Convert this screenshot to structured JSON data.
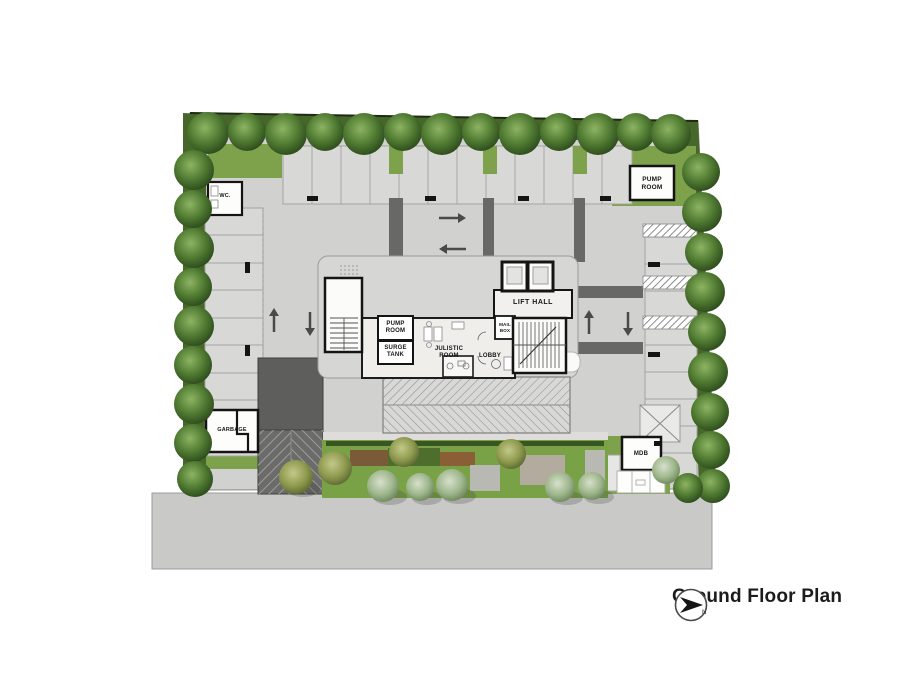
{
  "plan": {
    "caption": "Ground Floor Plan",
    "north_letter": "N",
    "labels": {
      "pump_room_ne": "PUMP\nROOM",
      "wc": "WC.",
      "pump_room": "PUMP\nROOM",
      "surge_tank": "SURGE\nTANK",
      "julistic_room": "JULISTIC\nROOM",
      "lobby": "LOBBY",
      "mail_box": "MAIL\nBOX",
      "lift_hall": "LIFT HALL",
      "garbage": "GARBAGE",
      "mdb": "MDB"
    },
    "colors": {
      "tree_dark": "#4e7a30",
      "tree_sage": "#a4bb92",
      "grass": "#7da24b",
      "hedge": "#46662a",
      "deck": "#d1d1d0",
      "stall": "#d8d8d7",
      "driveway_dark": "#686867",
      "ramp_dark": "#5e5e5d",
      "road": "#c9c9c8",
      "wall": "#141414",
      "core_floor": "#efeeeb"
    }
  }
}
